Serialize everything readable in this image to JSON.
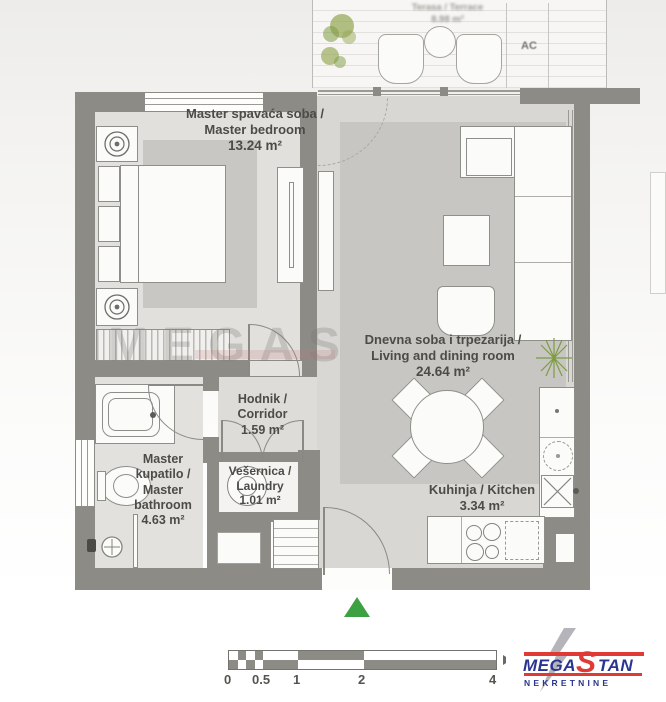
{
  "plan": {
    "terrace": {
      "title": "Terasa / Terrace",
      "area": "8.98 m²",
      "ac": "AC"
    },
    "bedroom": {
      "title_sr": "Master spavaća soba /",
      "title_en": "Master bedroom",
      "area": "13.24 m²"
    },
    "living": {
      "title_sr": "Dnevna soba i trpezarija /",
      "title_en": "Living and dining room",
      "area": "24.64 m²"
    },
    "corridor": {
      "title_sr": "Hodnik /",
      "title_en": "Corridor",
      "area": "1.59 m²"
    },
    "bathroom": {
      "line1": "Master",
      "line2": "kupatilo /",
      "line3": "Master",
      "line4": "bathroom",
      "area": "4.63 m²"
    },
    "laundry": {
      "title_sr": "Vešernica /",
      "title_en": "Laundry",
      "area": "1.01 m²"
    },
    "kitchen": {
      "title": "Kuhinja / Kitchen",
      "area": "3.34 m²"
    }
  },
  "watermark": {
    "text": "MEGAS"
  },
  "scale_bar": {
    "labels": [
      "0",
      "0.5",
      "1",
      "2",
      "4"
    ]
  },
  "logo": {
    "word_part1": "MEGA",
    "word_part2": "S",
    "word_part3": "TAN",
    "subtitle": "NEKRETNINE"
  },
  "colors": {
    "wall": "#8c8b85",
    "entrance_marker_green": "#3da144",
    "plant_green": "#7e9b44",
    "logo_blue": "#2a3590",
    "logo_red": "#e03a36"
  }
}
